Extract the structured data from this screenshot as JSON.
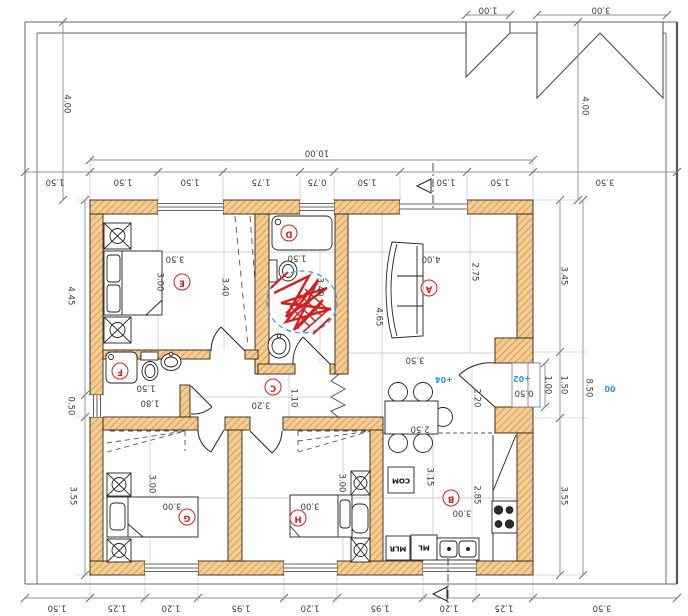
{
  "drawing": {
    "kind": "floor-plan",
    "orientation": "rotated-180",
    "overall_width_label": "10.00",
    "overall_height_label": "8.50"
  },
  "colors": {
    "wall_fill": "#f2cd95",
    "wall_hatch": "#d89140",
    "dim_text": "#3a3a3a",
    "room_label": "#cc2323",
    "level_blue": "#2f93e8",
    "markup_red": "#d42020",
    "markup_blue_dashed": "#4aa0e8"
  },
  "rooms": [
    {
      "id": "E",
      "x": 182,
      "y": 282
    },
    {
      "id": "D",
      "x": 289,
      "y": 233
    },
    {
      "id": "A",
      "x": 429,
      "y": 288
    },
    {
      "id": "C",
      "x": 273,
      "y": 387
    },
    {
      "id": "F",
      "x": 120,
      "y": 371
    },
    {
      "id": "G",
      "x": 187,
      "y": 517
    },
    {
      "id": "H",
      "x": 298,
      "y": 518
    },
    {
      "id": "B",
      "x": 451,
      "y": 498
    }
  ],
  "dim_labels": [
    {
      "t": "1.00",
      "x": 488,
      "y": 9,
      "o": "h"
    },
    {
      "t": "3.00",
      "x": 601,
      "y": 9,
      "o": "h"
    },
    {
      "t": "4.00",
      "x": 66,
      "y": 104,
      "o": "v"
    },
    {
      "t": "4.00",
      "x": 584,
      "y": 106,
      "o": "v"
    },
    {
      "t": "10.00",
      "x": 317,
      "y": 152,
      "o": "h"
    },
    {
      "t": "1.50",
      "x": 55,
      "y": 181,
      "o": "h"
    },
    {
      "t": "1.50",
      "x": 123,
      "y": 181,
      "o": "h"
    },
    {
      "t": "1.50",
      "x": 190,
      "y": 181,
      "o": "h"
    },
    {
      "t": "1.75",
      "x": 261,
      "y": 181,
      "o": "h"
    },
    {
      "t": "0.75",
      "x": 317,
      "y": 181,
      "o": "h"
    },
    {
      "t": "1.50",
      "x": 367,
      "y": 181,
      "o": "h"
    },
    {
      "t": "1.50",
      "x": 446,
      "y": 181,
      "o": "h"
    },
    {
      "t": "1.50",
      "x": 500,
      "y": 181,
      "o": "h"
    },
    {
      "t": "3.50",
      "x": 605,
      "y": 181,
      "o": "h"
    },
    {
      "t": "4.45",
      "x": 70,
      "y": 296,
      "o": "v"
    },
    {
      "t": "0.50",
      "x": 70,
      "y": 406,
      "o": "v"
    },
    {
      "t": "3.55",
      "x": 72,
      "y": 496,
      "o": "v"
    },
    {
      "t": "3.45",
      "x": 563,
      "y": 276,
      "o": "v"
    },
    {
      "t": "1.50",
      "x": 563,
      "y": 385,
      "o": "v"
    },
    {
      "t": "1.00",
      "x": 547,
      "y": 385,
      "o": "v"
    },
    {
      "t": "8.50",
      "x": 588,
      "y": 388,
      "o": "v"
    },
    {
      "t": "3.55",
      "x": 563,
      "y": 496,
      "o": "v"
    },
    {
      "t": "3.50",
      "x": 175,
      "y": 258,
      "o": "h"
    },
    {
      "t": "3.00",
      "x": 159,
      "y": 282,
      "o": "v"
    },
    {
      "t": "3.40",
      "x": 224,
      "y": 287,
      "o": "v"
    },
    {
      "t": "1.50",
      "x": 297,
      "y": 257,
      "o": "h"
    },
    {
      "t": "3.40",
      "x": 319,
      "y": 287,
      "o": "v"
    },
    {
      "t": "4.00",
      "x": 431,
      "y": 258,
      "o": "h"
    },
    {
      "t": "2.75",
      "x": 474,
      "y": 272,
      "o": "v"
    },
    {
      "t": "4.65",
      "x": 378,
      "y": 317,
      "o": "v"
    },
    {
      "t": "3.50",
      "x": 415,
      "y": 359,
      "o": "h"
    },
    {
      "t": "3.20",
      "x": 261,
      "y": 404,
      "o": "h"
    },
    {
      "t": "1.10",
      "x": 293,
      "y": 398,
      "o": "v"
    },
    {
      "t": "1.50",
      "x": 146,
      "y": 387,
      "o": "h"
    },
    {
      "t": "1.80",
      "x": 150,
      "y": 402,
      "o": "h"
    },
    {
      "t": "2.20",
      "x": 476,
      "y": 398,
      "o": "v"
    },
    {
      "t": "2.50",
      "x": 420,
      "y": 428,
      "o": "h"
    },
    {
      "t": "0.50",
      "x": 524,
      "y": 392,
      "o": "h"
    },
    {
      "t": "3.00",
      "x": 151,
      "y": 484,
      "o": "v"
    },
    {
      "t": "3.00",
      "x": 172,
      "y": 505,
      "o": "h"
    },
    {
      "t": "3.00",
      "x": 341,
      "y": 483,
      "o": "v"
    },
    {
      "t": "3.00",
      "x": 310,
      "y": 505,
      "o": "h"
    },
    {
      "t": "3.15",
      "x": 429,
      "y": 477,
      "o": "v"
    },
    {
      "t": "2.85",
      "x": 476,
      "y": 495,
      "o": "v"
    },
    {
      "t": "3.00",
      "x": 462,
      "y": 512,
      "o": "h"
    },
    {
      "t": "1.50",
      "x": 57,
      "y": 607,
      "o": "h"
    },
    {
      "t": "1.25",
      "x": 117,
      "y": 607,
      "o": "h"
    },
    {
      "t": "1.20",
      "x": 171,
      "y": 607,
      "o": "h"
    },
    {
      "t": "1.95",
      "x": 241,
      "y": 607,
      "o": "h"
    },
    {
      "t": "1.20",
      "x": 310,
      "y": 607,
      "o": "h"
    },
    {
      "t": "1.95",
      "x": 380,
      "y": 607,
      "o": "h"
    },
    {
      "t": "1.20",
      "x": 449,
      "y": 607,
      "o": "h"
    },
    {
      "t": "1.25",
      "x": 504,
      "y": 607,
      "o": "h"
    },
    {
      "t": "3.50",
      "x": 602,
      "y": 607,
      "o": "h"
    }
  ],
  "level_labels": [
    {
      "t": "+04",
      "x": 444,
      "y": 379
    },
    {
      "t": "+02",
      "x": 522,
      "y": 378
    },
    {
      "t": "00",
      "x": 610,
      "y": 388
    }
  ],
  "appliance_labels": [
    {
      "t": "COM",
      "x": 401,
      "y": 480
    },
    {
      "t": "MLR",
      "x": 398,
      "y": 548
    },
    {
      "t": "ML",
      "x": 424,
      "y": 547
    }
  ]
}
